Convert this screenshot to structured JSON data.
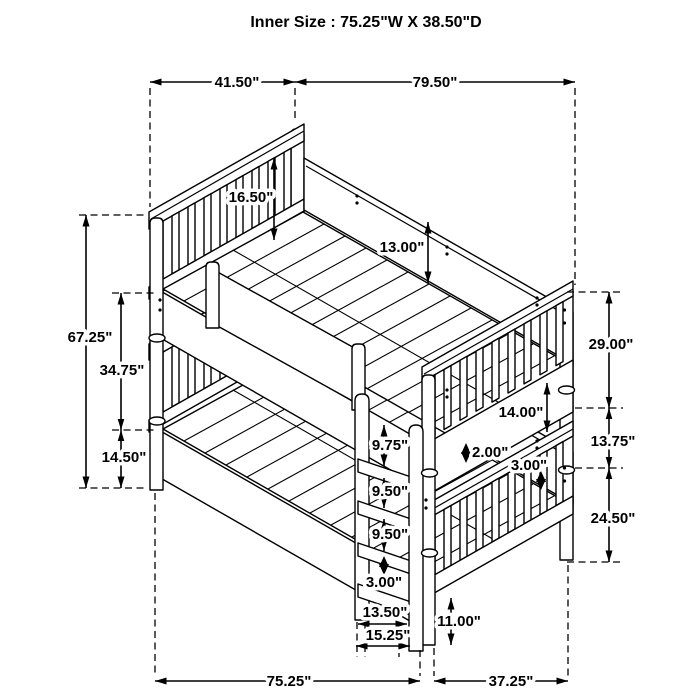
{
  "header": {
    "title": "Inner Size : 75.25\"W X  38.50\"D"
  },
  "diagram": {
    "type": "isometric-dimension-drawing",
    "subject": "twin-over-twin bunk bed with ladder",
    "line_color": "#000000",
    "background_color": "#ffffff"
  },
  "dimensions": {
    "headboard_width": "41.50\"",
    "bed_length": "79.50\"",
    "headboard_panel_height": "16.50\"",
    "side_rail_height": "13.00\"",
    "overall_height": "67.25\"",
    "upper_rail_to_lower_rail": "34.75\"",
    "lower_rail_to_floor": "14.50\"",
    "right_upper_section": "29.00\"",
    "right_mid_section": "13.75\"",
    "right_lower_section": "24.50\"",
    "footboard_panel_height": "14.00\"",
    "slat_thickness": "2.00\"",
    "rail_thickness": "3.00\"",
    "ladder_gap_top": "9.75\"",
    "ladder_gap_mid": "9.50\"",
    "ladder_gap_lower": "9.50\"",
    "ladder_rung_thickness": "3.00\"",
    "ladder_inner_width": "13.50\"",
    "ladder_outer_width": "15.25\"",
    "leg_height": "11.00\"",
    "base_length": "75.25\"",
    "base_foot_width": "37.25\""
  }
}
